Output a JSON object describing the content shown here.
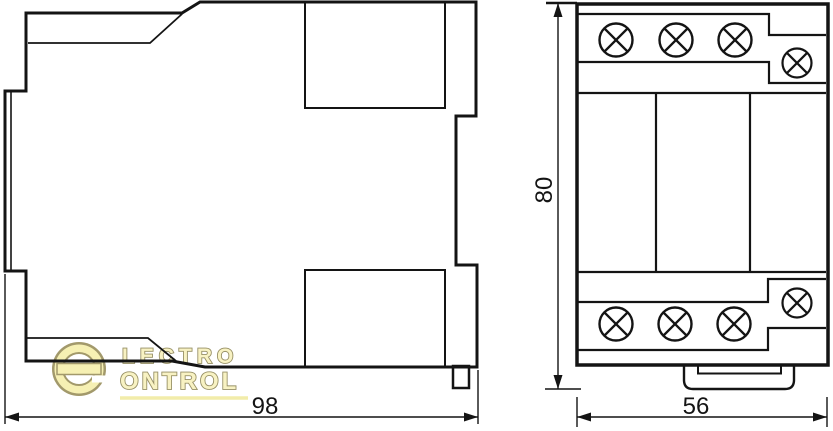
{
  "page": {
    "background": "#ffffff",
    "line_color": "#141414"
  },
  "drawing": {
    "type": "technical-dimension-drawing",
    "views": {
      "side": {
        "dimension_width": "98"
      },
      "front": {
        "dimension_height": "80",
        "dimension_width": "56"
      }
    },
    "icons": {
      "screw_terminal": "circle-with-x-cross",
      "din_clip": "rounded-tab"
    }
  },
  "watermark": {
    "emblem": "e",
    "line1": "LECTRO",
    "line2": "ONTROL",
    "fill": "#F8F2BF",
    "outline": "#968C55",
    "underline_color": "#F2EBA4"
  }
}
